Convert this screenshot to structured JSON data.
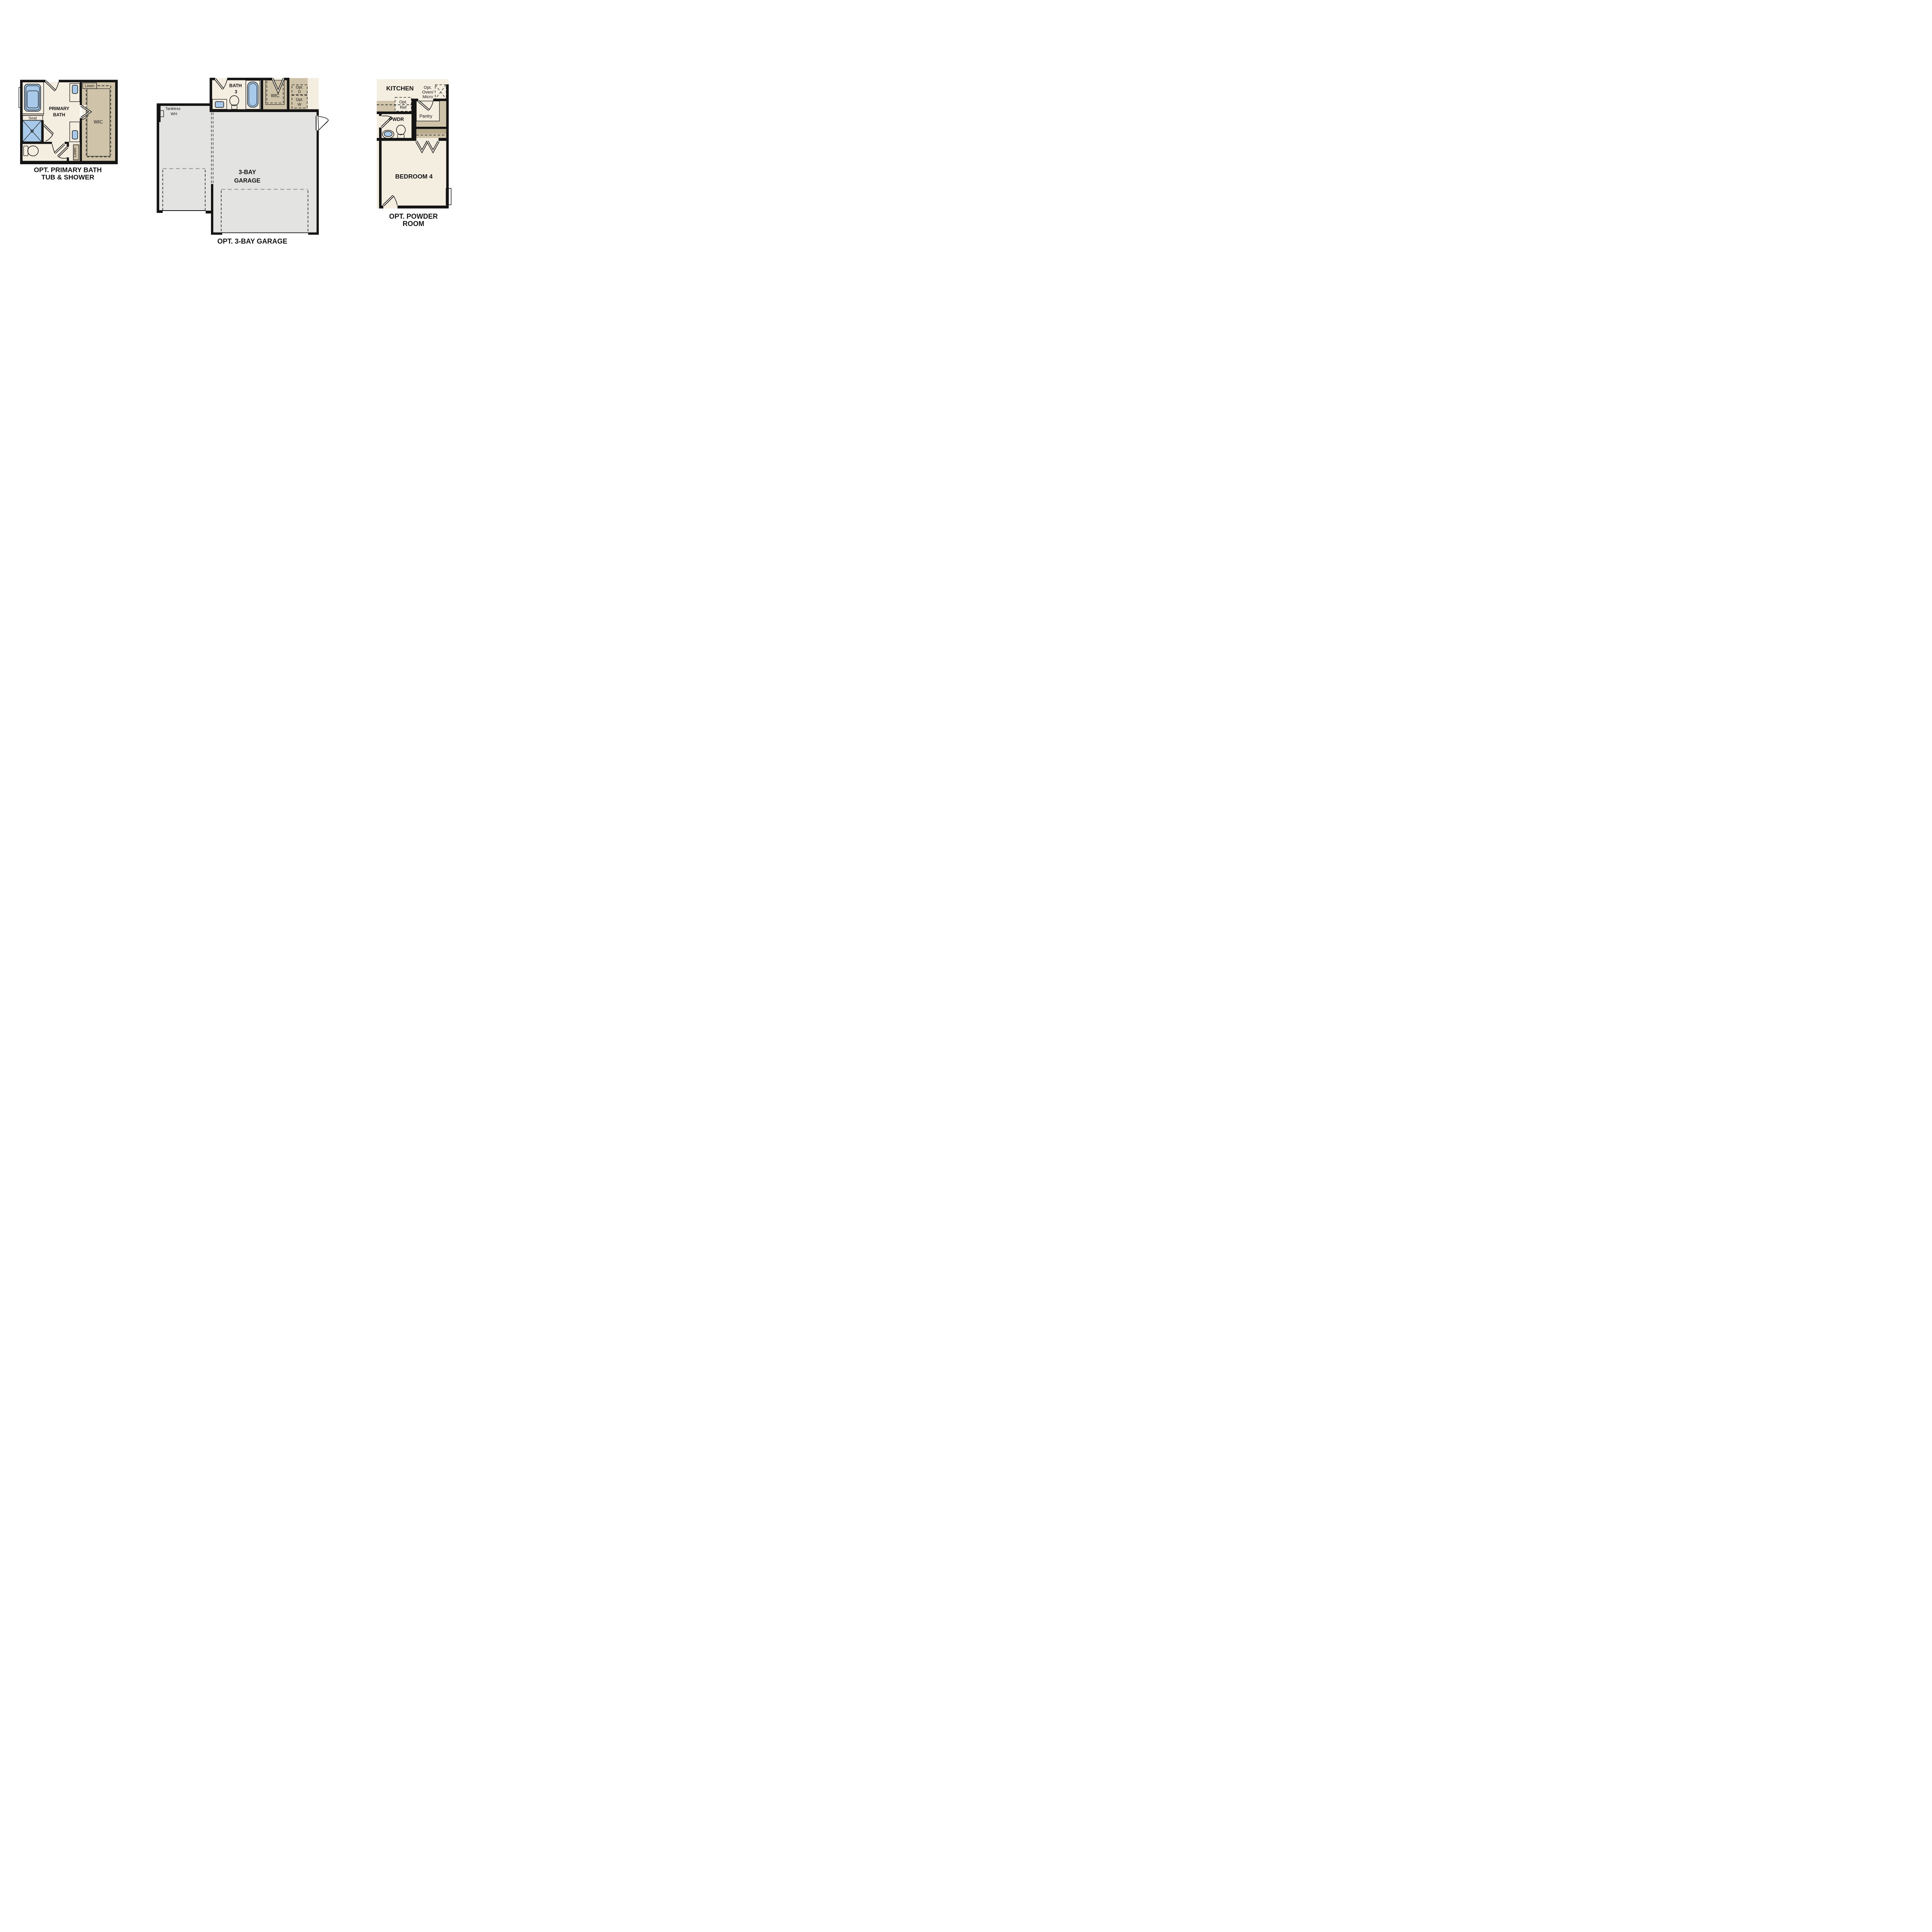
{
  "document": {
    "type": "floor-plan-options-sheet",
    "background": "#ffffff"
  },
  "colors": {
    "wall": "#141414",
    "floor_cream": "#f4eee1",
    "cabinet_tan": "#cfc3a9",
    "cabinet_tan_dark": "#b9ab8d",
    "fixture_blue": "#a8c9e9",
    "garage_gray": "#e3e3e2",
    "appliance_gray": "#e0e4e1",
    "dashed_gray": "#9a9a9a"
  },
  "plans": {
    "primary_bath": {
      "caption_line1": "OPT. PRIMARY BATH",
      "caption_line2": "TUB & SHOWER",
      "labels": {
        "linen_top": "Linen",
        "seat": "Seat",
        "room_line1": "PRIMARY",
        "room_line2": "BATH",
        "wic": "WIC",
        "linen_bottom": "Linen"
      }
    },
    "garage": {
      "caption": "OPT. 3-BAY GARAGE",
      "labels": {
        "bath_line1": "BATH",
        "bath_line2": "3",
        "tankless_line1": "Tankless",
        "tankless_line2": "WH",
        "wic": "WIC",
        "opt_d_line1": "Opt.",
        "opt_d_line2": "D",
        "opt_w_line1": "Opt.",
        "opt_w_line2": "W",
        "garage_line1": "3-BAY",
        "garage_line2": "GARAGE"
      }
    },
    "powder_room": {
      "caption_line1": "OPT. POWDER",
      "caption_line2": "ROOM",
      "labels": {
        "kitchen": "KITCHEN",
        "oven_line1": "Opt.",
        "oven_line2": "Oven/",
        "oven_line3": "Micro",
        "ref_line1": "Opt.",
        "ref_line2": "Ref",
        "pantry": "Pantry",
        "pwdr": "PWDR",
        "bedroom": "BEDROOM 4"
      }
    }
  }
}
